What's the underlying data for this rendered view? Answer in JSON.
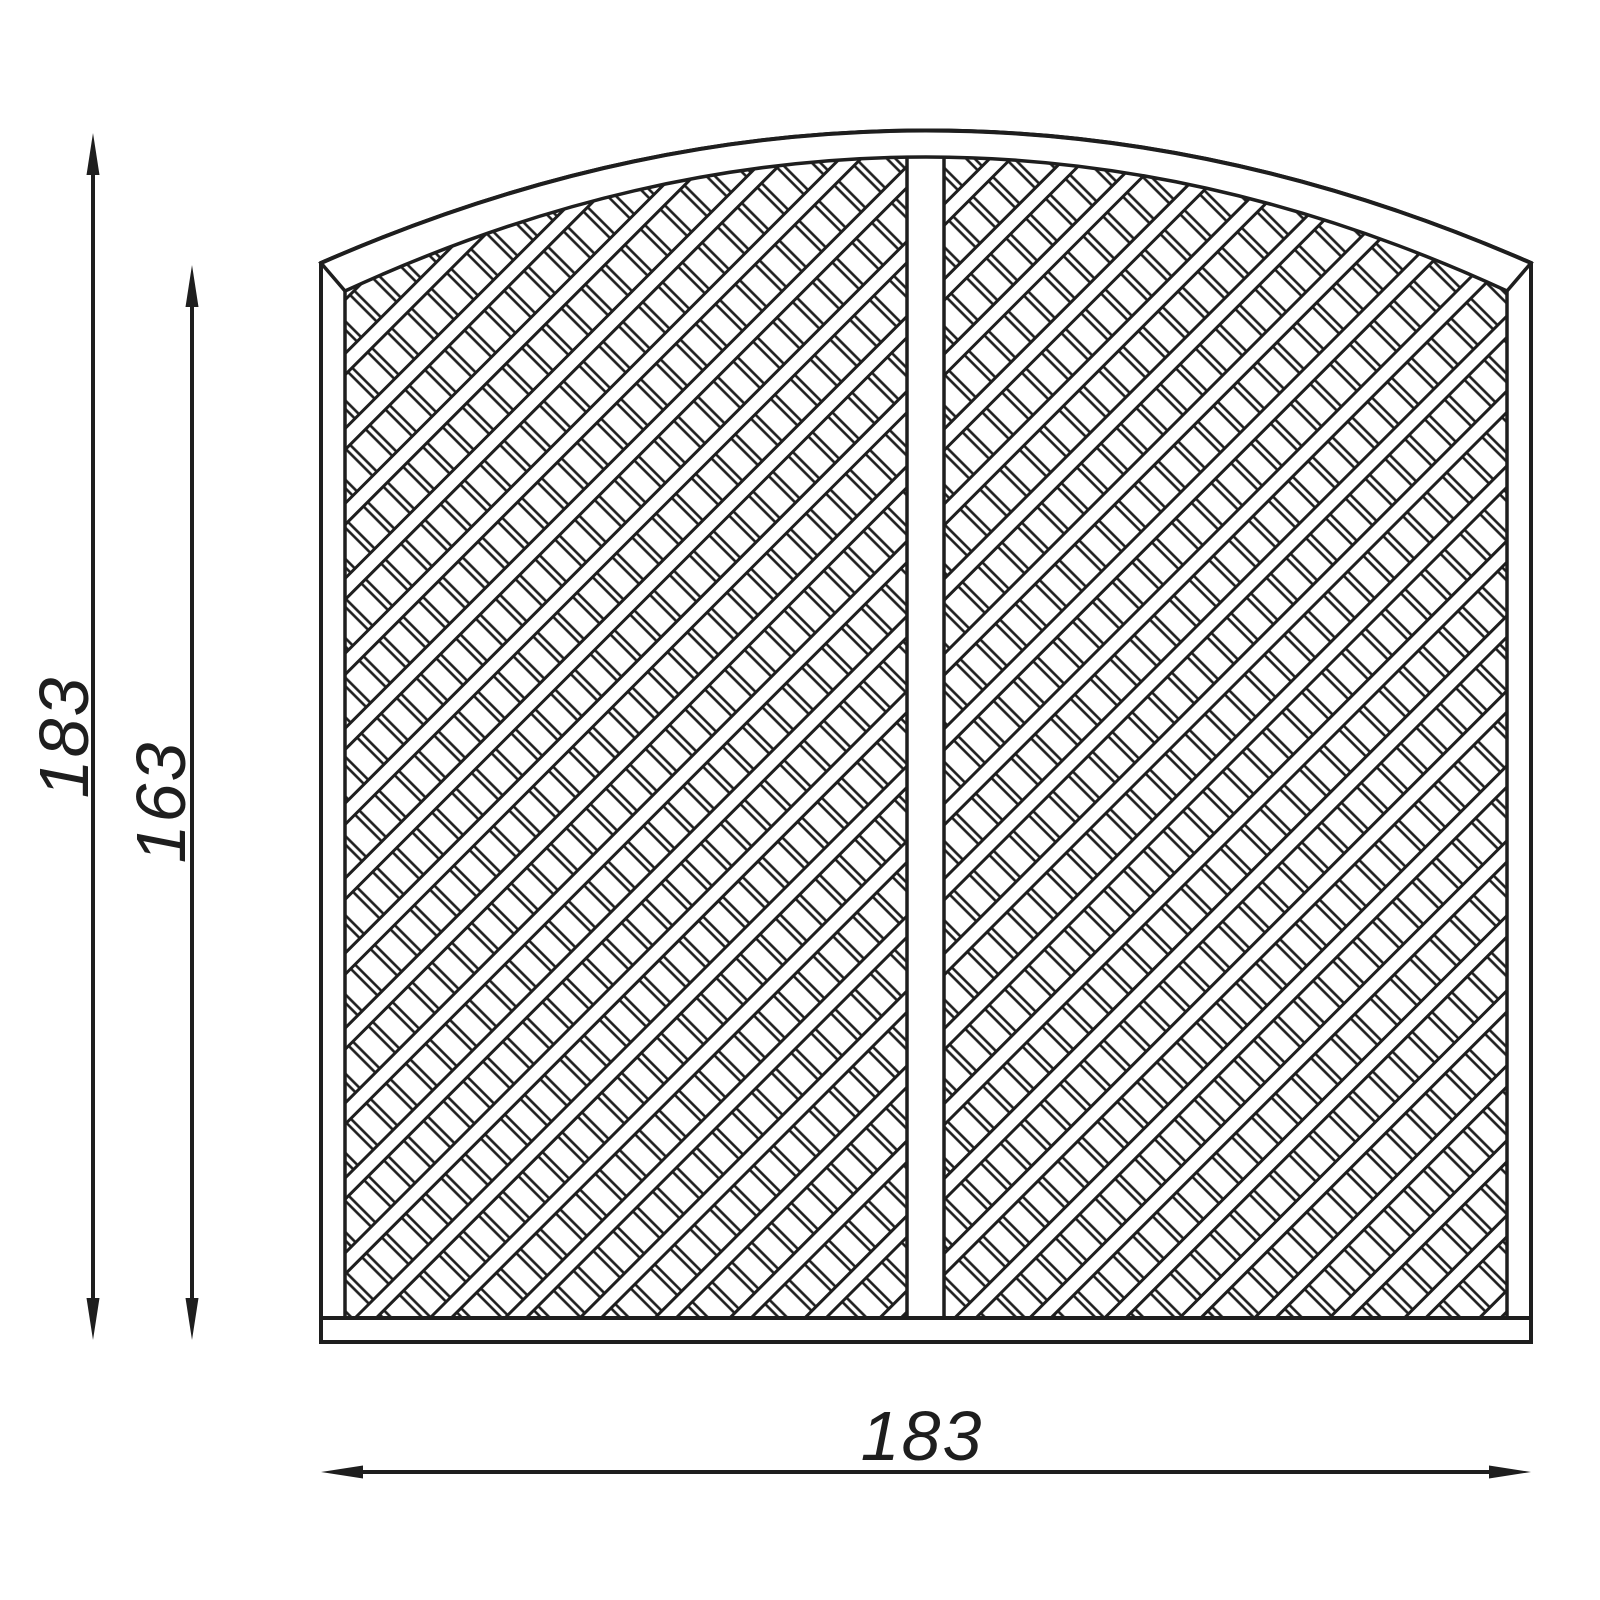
{
  "drawing": {
    "type": "technical-drawing",
    "subject": "arched-lattice-fence-panel",
    "background_color": "#ffffff",
    "line_color": "#1e1e1e",
    "dimensions": {
      "overall_height": "183",
      "side_height": "163",
      "width": "183"
    }
  }
}
